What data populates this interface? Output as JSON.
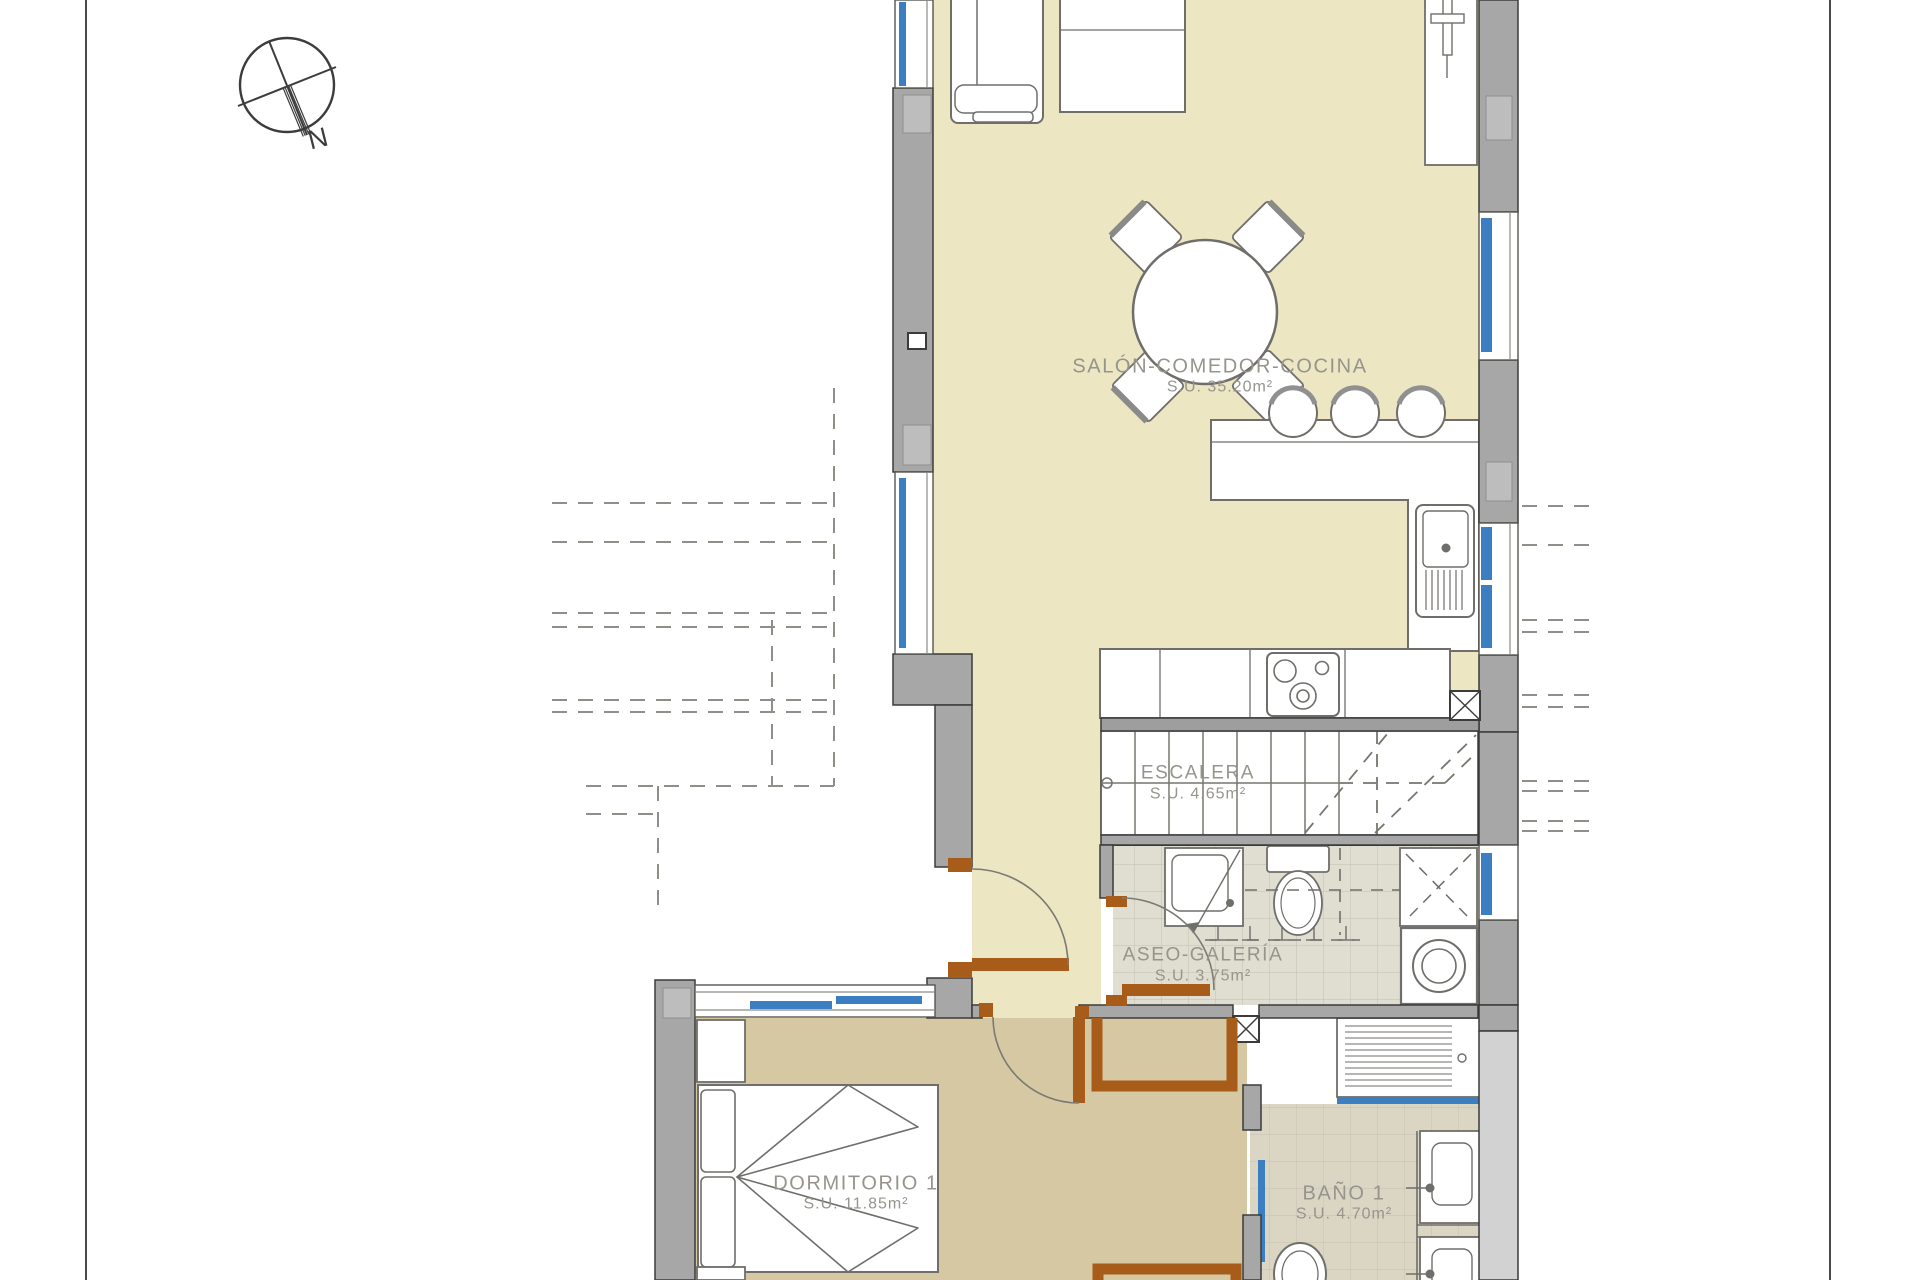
{
  "page": {
    "background": "#ffffff",
    "margin_line_color": "#4a4a4a"
  },
  "palette": {
    "floor_cream": "#ece6c3",
    "floor_tan": "#d5c8a2",
    "tile_aseo": "#e0ddd1",
    "tile_bano": "#dbd5c4",
    "tile_line": "#c9c4b4",
    "wall_gray": "#a7a7a7",
    "wall_inset": "#bdbdbd",
    "outline_dark": "#3b3b3b",
    "fixture_line": "#6f6e6a",
    "window_blue": "#3c7ec2",
    "door_brown": "#a85c1a",
    "label_gray": "#96948c",
    "dash_gray": "#8f8f8a"
  },
  "compass": {
    "label": "N"
  },
  "rooms": [
    {
      "name": "SALÓN-COMEDOR-COCINA",
      "area": "S.U. 35.20m²"
    },
    {
      "name": "ESCALERA",
      "area": "S.U. 4.65m²"
    },
    {
      "name": "ASEO-GALERÍA",
      "area": "S.U. 3.75m²"
    },
    {
      "name": "DORMITORIO 1",
      "area": "S.U. 11.85m²"
    },
    {
      "name": "BAÑO 1",
      "area": "S.U. 4.70m²"
    }
  ]
}
